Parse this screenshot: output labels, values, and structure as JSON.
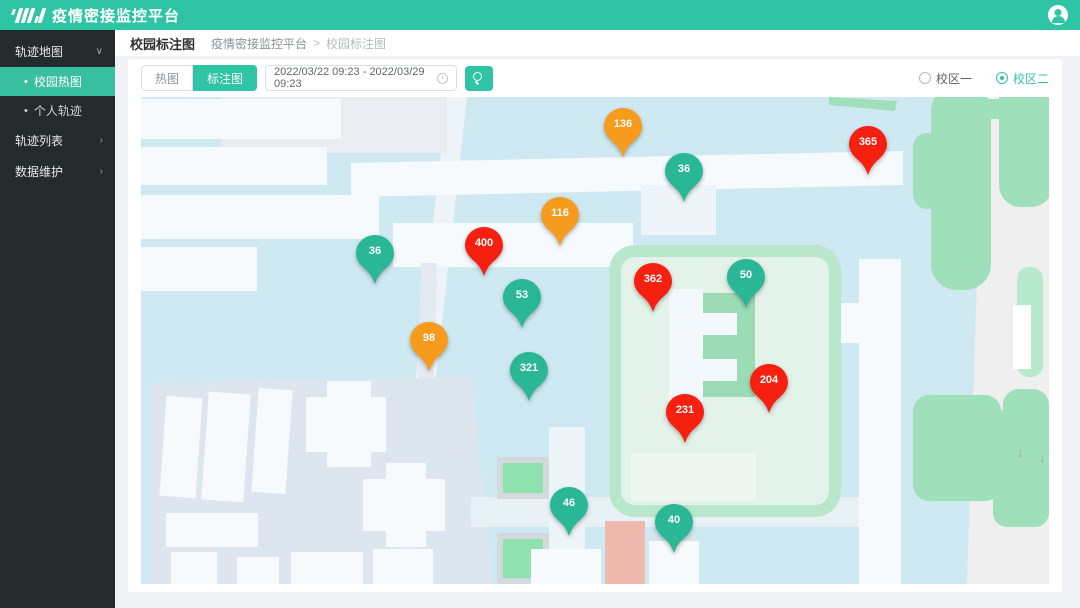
{
  "header": {
    "title": "疫情密接监控平台"
  },
  "sidebar": {
    "group_map": "轨迹地图",
    "item_heatmap": "校园热图",
    "item_personal": "个人轨迹",
    "group_list": "轨迹列表",
    "group_data": "数据维护"
  },
  "breadcrumb": {
    "page_title": "校园标注图",
    "root": "疫情密接监控平台",
    "separator": ">",
    "current": "校园标注图"
  },
  "toolbar": {
    "tab_heatmap": "热图",
    "tab_marker": "标注图",
    "date_range": "2022/03/22 09:23 - 2022/03/29 09:23",
    "campus_one": "校区一",
    "campus_two": "校区二",
    "selected_campus": "校区二"
  },
  "icons": {
    "chevron_down": "∨",
    "chevron_right": "›",
    "bullet": "•",
    "scroll_down": "↓"
  },
  "map": {
    "colors": {
      "red": "#f5200f",
      "orange": "#f79b1f",
      "green": "#2ab795",
      "brand": "#2fc4a6"
    },
    "markers": [
      {
        "value": "136",
        "color": "orange",
        "x": 482,
        "y": 29
      },
      {
        "value": "36",
        "color": "green",
        "x": 543,
        "y": 74
      },
      {
        "value": "365",
        "color": "red",
        "x": 727,
        "y": 47
      },
      {
        "value": "116",
        "color": "orange",
        "x": 419,
        "y": 118
      },
      {
        "value": "400",
        "color": "red",
        "x": 343,
        "y": 148
      },
      {
        "value": "36",
        "color": "green",
        "x": 234,
        "y": 156
      },
      {
        "value": "362",
        "color": "red",
        "x": 512,
        "y": 184
      },
      {
        "value": "50",
        "color": "green",
        "x": 605,
        "y": 180
      },
      {
        "value": "53",
        "color": "green",
        "x": 381,
        "y": 200
      },
      {
        "value": "98",
        "color": "orange",
        "x": 288,
        "y": 243
      },
      {
        "value": "321",
        "color": "green",
        "x": 388,
        "y": 273
      },
      {
        "value": "204",
        "color": "red",
        "x": 628,
        "y": 285
      },
      {
        "value": "231",
        "color": "red",
        "x": 544,
        "y": 315
      },
      {
        "value": "46",
        "color": "green",
        "x": 428,
        "y": 408
      },
      {
        "value": "40",
        "color": "green",
        "x": 533,
        "y": 425
      }
    ]
  }
}
